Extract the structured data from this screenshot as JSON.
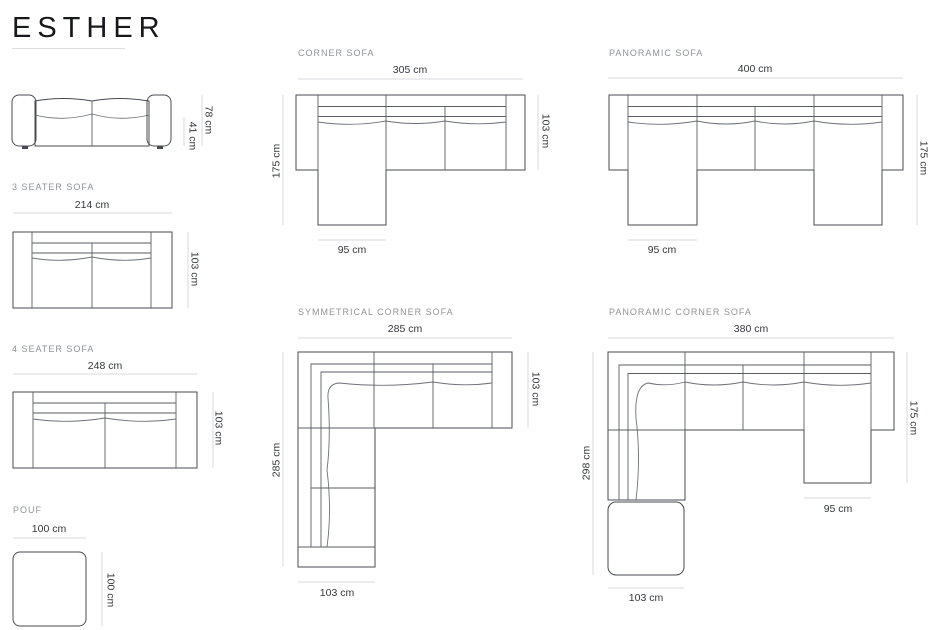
{
  "brand": {
    "title": "ESTHER"
  },
  "products": {
    "hero_front_view": {
      "total_height": "78 cm",
      "seat_height": "41 cm"
    },
    "three_seater": {
      "label": "3 SEATER SOFA",
      "width": "214 cm",
      "depth": "103 cm"
    },
    "four_seater": {
      "label": "4 SEATER SOFA",
      "width": "248 cm",
      "depth": "103 cm"
    },
    "pouf": {
      "label": "POUF",
      "width": "100 cm",
      "depth": "100 cm"
    },
    "corner_sofa": {
      "label": "CORNER SOFA",
      "width": "305 cm",
      "total_depth": "175 cm",
      "seat_depth": "103 cm",
      "chaise_width": "95 cm"
    },
    "panoramic_sofa": {
      "label": "PANORAMIC SOFA",
      "width": "400 cm",
      "total_depth": "175 cm",
      "chaise_width": "95 cm"
    },
    "symmetrical_corner_sofa": {
      "label": "SYMMETRICAL CORNER SOFA",
      "width": "285 cm",
      "left_depth": "285 cm",
      "seat_depth": "103 cm",
      "leg_width": "103 cm"
    },
    "panoramic_corner_sofa": {
      "label": "PANORAMIC CORNER SOFA",
      "width": "380 cm",
      "left_depth": "298 cm",
      "right_depth": "175 cm",
      "chaise_width": "95 cm",
      "leg_width": "103 cm"
    }
  },
  "colors": {
    "outline": "#474b51",
    "dimension_line": "#d8dade",
    "dimension_text": "#33373d",
    "section_label": "#909396",
    "title": "#17181b"
  }
}
